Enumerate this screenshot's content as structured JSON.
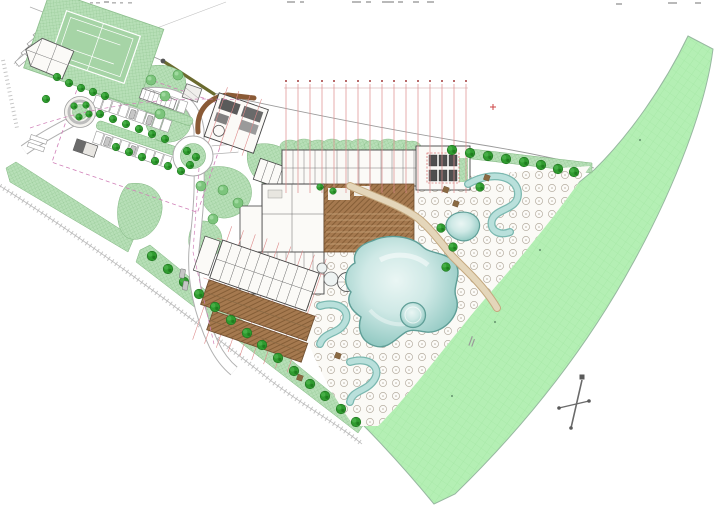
{
  "canvas": {
    "width": 726,
    "height": 510,
    "background": "#ffffff"
  },
  "drawing": {
    "kind": "resort-site-plan",
    "annotations": {
      "top_edge_text_fragments": "illegible (cropped at top edge)",
      "grid_axis_ticks": "illegible tiny numerals above red structural grid",
      "lawn_label": "illegible tiny rotated note"
    }
  },
  "colors": {
    "landscape_green": "#b7dfb7",
    "landscape_hatch": "#8fc48f",
    "lawn_green": "#b4efb4",
    "lawn_grid": "#9ce49c",
    "lawn_edge": "#97b8a0",
    "court_green": "#a6d4a6",
    "tree_green": "#2f9b2f",
    "tree_dark": "#1c731c",
    "bush_green": "#7cc47c",
    "bush_edge": "#55a055",
    "pool_edge": "#5f9e97",
    "pool_fill": "#9ed2cc",
    "pool_light": "#e8f5f3",
    "river_fill": "#b9e0db",
    "river_edge": "#7ab8b0",
    "deck_brown": "#a5794f",
    "deck_hatch": "#7d5731",
    "deck_step": "#caa87f",
    "path_tan": "#e4d6ba",
    "path_tan_edge": "#c4a87e",
    "path_brown": "#8a5a36",
    "road_casing": "#b0b0b0",
    "road_fill": "#ffffff",
    "building_fill": "#fbfaf7",
    "building_outline": "#444444",
    "roof_dark": "#5a5a5a",
    "grid_red": "#dd8a8a",
    "grid_red_dark": "#b86a6a",
    "accent_red": "#cc4444",
    "dashed_pink": "#d080b8",
    "boundary_gray": "#c6c6c6",
    "line_gray": "#9a9a9a",
    "wall_olive": "#6b6b2f",
    "compass_gray": "#6a6a6a",
    "umbrella_stroke": "#b5ada0",
    "mark_gray": "#b9b9b9"
  }
}
